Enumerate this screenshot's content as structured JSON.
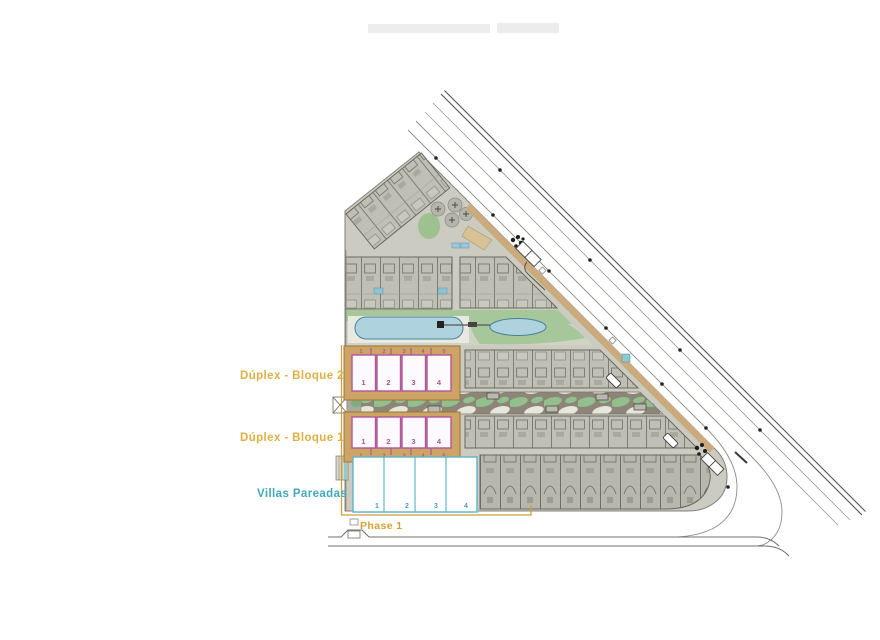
{
  "plan": {
    "blocks": {
      "bloque2": {
        "label": "Dúplex - Bloque 2",
        "top_ticks": [
          "1",
          "2",
          "3",
          "4",
          "5"
        ],
        "units": [
          "1",
          "2",
          "3",
          "4"
        ]
      },
      "bloque1": {
        "label": "Dúplex - Bloque 1",
        "units": [
          "1",
          "2",
          "3",
          "4"
        ],
        "bottom_ticks": [
          "1",
          "2",
          "3",
          "4",
          "5"
        ]
      },
      "villas": {
        "label": "Villas Pareadas",
        "units": [
          "1",
          "2",
          "3",
          "4"
        ]
      },
      "phase": {
        "label": "Phase 1"
      }
    },
    "colors": {
      "label_gold": "#DFAF45",
      "phase_line_gold": "#C9A23E",
      "block_pink": "#B0569C",
      "villas_cyan": "#62B8C7",
      "villas_label_cyan": "#3FA9BD",
      "phase_tan_fill": "#CDA465",
      "pool_blue": "#AED3DF",
      "lawn_green": "#9CC393",
      "ground_grey": "#CBCBC1",
      "building_grey": "#BFBFB6",
      "road_line": "#555555"
    }
  }
}
